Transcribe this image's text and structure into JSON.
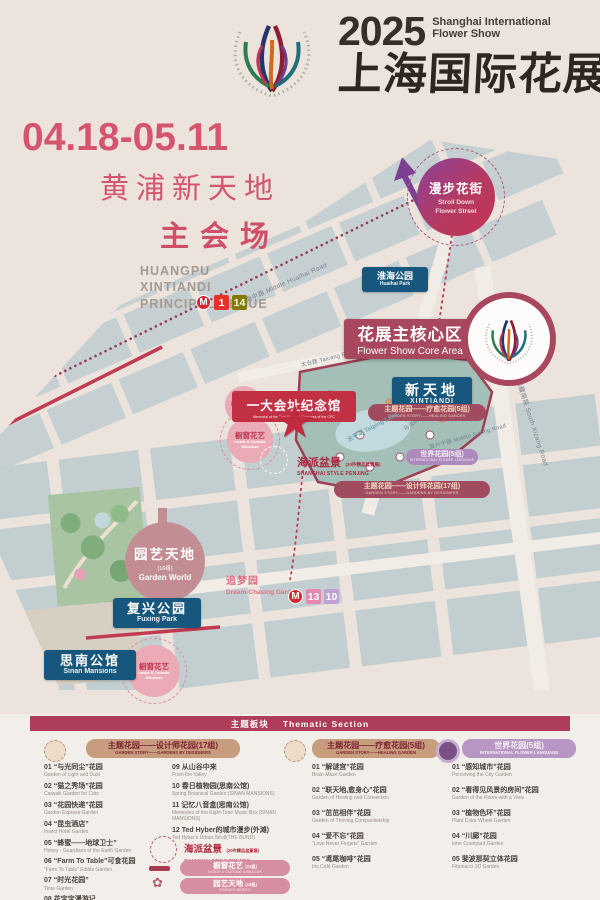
{
  "header": {
    "year": "2025",
    "title_line1": "Shanghai International",
    "title_line2": "Flower Show",
    "title_zh": "上海国际花展"
  },
  "venue": {
    "dates": "04.18-05.11",
    "name_zh": "黄浦新天地",
    "hall_zh": "主会场",
    "en1": "HUANGPU",
    "en2": "XINTIANDI",
    "en3": "PRINCIPAL VENUE"
  },
  "map": {
    "stroll_zh": "漫步花街",
    "stroll_en1": "Stroll Down",
    "stroll_en2": "Flower Street",
    "huaihai_park_zh": "淮海公园",
    "huaihai_park_en": "Huaihai Park",
    "core_zh": "花展主核心区",
    "core_en": "Flower Show Core Area",
    "xintiandi_zh": "新天地",
    "xintiandi_en": "XINTIANDI",
    "memorial_zh": "一大会址纪念馆",
    "memorial_en": "Memorial of the First National Congress of the CPC",
    "window_zh": "橱窗花艺",
    "window_en1": "Inside & Outside",
    "window_en2": "Windows",
    "penjing_zh": "海派盆景",
    "penjing_sub": "(20件精品盆景展)",
    "penjing_en": "SHANGHAI STYLE PENJING",
    "theme_healing_zh": "主题花园——疗愈花园(5组)",
    "theme_healing_en": "GARDEN STORY——HEALING GARDEN",
    "theme_designers_zh": "主题花园——设计师花园(17组)",
    "theme_designers_en": "GARDEN STORY——GARDENS BY DESIGNERS",
    "world_zh": "世界花园(5组)",
    "world_en": "INTERNATIONAL FLOWER LANGUAGE",
    "gardenworld_zh": "园艺天地",
    "gardenworld_sub": "(16组)",
    "gardenworld_en": "Garden World",
    "dream_zh": "追梦园",
    "dream_en": "Dream-Chasing Garden",
    "fuxing_zh": "复兴公园",
    "fuxing_en": "Fuxing Park",
    "sinan_zh": "思南公馆",
    "sinan_en": "Sinan Mansions",
    "lake": "太平湖 Taiping Lake",
    "road_huaihai": "淮海中路  Middle Huaihai Road",
    "road_taicang": "太仓路 Taicang Road",
    "road_madang": "马当路 Madang Road",
    "road_fuxing": "复兴中路 Middle Fuxing Road",
    "road_xizang": "西藏南路 South Xizang Road",
    "metro_l1": "1",
    "metro_l14": "14",
    "metro_l13": "13",
    "metro_l10": "10",
    "metro_m": "M"
  },
  "legend": {
    "bar_zh": "主题板块",
    "bar_en": "Thematic Section",
    "designers": {
      "zh": "主题花园——设计师花园(17组)",
      "en": "GARDEN STORY——GARDENS BY DESIGNERS",
      "items": [
        {
          "zh": "01 “与光同尘”花园",
          "en": "Garden of Light and Dust"
        },
        {
          "zh": "02 “猫之秀场”花园",
          "en": "Catwalk Garden for Cats"
        },
        {
          "zh": "03 “花园快递”花园",
          "en": "Garden Express Garden"
        },
        {
          "zh": "04 “昆虫酒店”",
          "en": "Insect Hotel Garden"
        },
        {
          "zh": "05 “蜂蜜——地球卫士”",
          "en": "Honey - Guardians of the Earth Garden"
        },
        {
          "zh": "06 “Farm To Table”可食花园",
          "en": "“Farm To Table” Edible Garden"
        },
        {
          "zh": "07 “时光花园”",
          "en": "Time Garden"
        },
        {
          "zh": "08 花宝宝漫游记",
          "en": "Flower Baby's Adventure"
        },
        {
          "zh": "09 从山谷中来",
          "en": "From the Valley"
        },
        {
          "zh": "10 春日植物园(思南公馆)",
          "en": "Spring Botanical Garden (SINAN MANSIONS)"
        },
        {
          "zh": "11 记忆八音盒(思南公馆)",
          "en": "Memories of the Eight-Tone Music Box (SINAN MANSIONS)"
        },
        {
          "zh": "12 Ted Hyber的城市漫步(外滩)",
          "en": "Ted Hyber's Urban Stroll(THE BUND)"
        }
      ]
    },
    "extras": {
      "penjing_zh": "海派盆景",
      "penjing_sub": "(20件精品盆景展)",
      "penjing_en": "SHANGHAI STYLE PENJING",
      "window_zh": "橱窗花艺",
      "window_sub": "(21组)",
      "window_en": "INSIDE & OUTSIDE WINDOWS",
      "gw_zh": "园艺天地",
      "gw_sub": "(16组)",
      "gw_en": "GARDEN WORLD"
    },
    "healing": {
      "zh": "主题花园——疗愈花园(5组)",
      "en": "GARDEN STORY——HEALING GARDEN",
      "items": [
        {
          "zh": "01 “解谜宫”花园",
          "en": "Brain-Maze Garden"
        },
        {
          "zh": "02 “联天地,愈身心”花园",
          "en": "Garden of Healing and Connection"
        },
        {
          "zh": "03 “茁茁相伴”花园",
          "en": "Garden of Thriving Companionship"
        },
        {
          "zh": "04 “爱不忘”花园",
          "en": "“Love Never Forgets” Garden"
        },
        {
          "zh": "05 “鸢尾咖啡”花园",
          "en": "Iris Café Garden"
        }
      ]
    },
    "world": {
      "zh": "世界花园(5组)",
      "en": "INTERNATIONAL FLOWER LANGUAGE",
      "items": [
        {
          "zh": "01 “感知城市”花园",
          "en": "Perceiving the City Garden"
        },
        {
          "zh": "02 “看得见风景的房间”花园",
          "en": "Garden of the Room with a View"
        },
        {
          "zh": "03 “植物色环”花园",
          "en": "Plant Color Wheel Garden"
        },
        {
          "zh": "04 “川廊”花园",
          "en": "Inter Courtyard Garden"
        },
        {
          "zh": "05 斐波那契立体花园",
          "en": "Fibonacci 3D Garden"
        }
      ]
    }
  }
}
